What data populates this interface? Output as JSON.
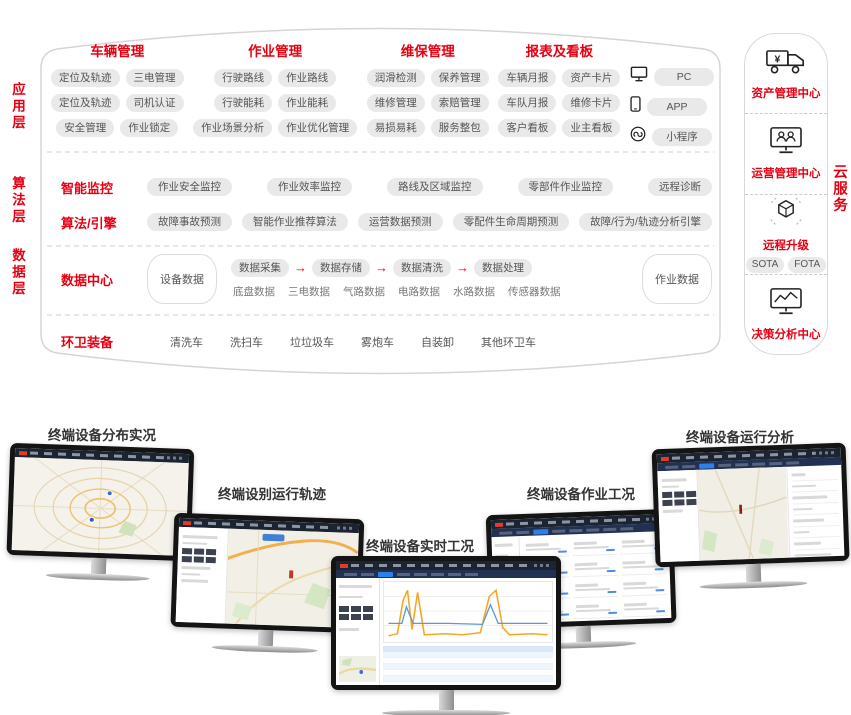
{
  "colors": {
    "accent_red": "#e60012",
    "pill_background": "#e9e9e9",
    "outline_gray": "#d5d5d5",
    "monitor_topbar": "#1c2431"
  },
  "layers": [
    "应用层",
    "算法层",
    "数据层"
  ],
  "app_groups": [
    {
      "title": "车辆管理",
      "rows": [
        [
          "定位及轨迹",
          "三电管理"
        ],
        [
          "定位及轨迹",
          "司机认证"
        ],
        [
          "安全管理",
          "作业锁定"
        ]
      ]
    },
    {
      "title": "作业管理",
      "rows": [
        [
          "行驶路线",
          "作业路线"
        ],
        [
          "行驶能耗",
          "作业能耗"
        ],
        [
          "作业场景分析",
          "作业优化管理"
        ]
      ]
    },
    {
      "title": "维保管理",
      "rows": [
        [
          "润滑检测",
          "保养管理"
        ],
        [
          "维修管理",
          "索赔管理"
        ],
        [
          "易损易耗",
          "服务整包"
        ]
      ]
    },
    {
      "title": "报表及看板",
      "rows": [
        [
          "车辆月报",
          "资产卡片"
        ],
        [
          "车队月报",
          "维修卡片"
        ],
        [
          "客户看板",
          "业主看板"
        ]
      ]
    }
  ],
  "clients": [
    {
      "icon": "pc-icon",
      "label": "PC"
    },
    {
      "icon": "phone-icon",
      "label": "APP"
    },
    {
      "icon": "miniprogram-icon",
      "label": "小程序"
    }
  ],
  "algo_rows": [
    {
      "title": "智能监控",
      "pills": [
        "作业安全监控",
        "作业效率监控",
        "路线及区域监控",
        "零部件作业监控",
        "远程诊断"
      ]
    },
    {
      "title": "算法/引擎",
      "pills": [
        "故障事故预测",
        "智能作业推荐算法",
        "运营数据预测",
        "零配件生命周期预测",
        "故障/行为/轨迹分析引擎"
      ]
    }
  ],
  "data_center": {
    "title": "数据中心",
    "left_db": "设备数据",
    "flow": [
      "数据采集",
      "数据存储",
      "数据清洗",
      "数据处理"
    ],
    "types": [
      "底盘数据",
      "三电数据",
      "气路数据",
      "电路数据",
      "水路数据",
      "传感器数据"
    ],
    "right_db": "作业数据"
  },
  "equipment": {
    "title": "环卫装备",
    "items": [
      "清洗车",
      "洗扫车",
      "垃垃圾车",
      "雾炮车",
      "自装卸",
      "其他环卫车"
    ]
  },
  "cloud_label": "云服务",
  "cloud_sections": [
    {
      "icon": "asset-truck-icon",
      "label": "资产管理中心",
      "pills": []
    },
    {
      "icon": "operations-monitor-icon",
      "label": "运营管理中心",
      "pills": []
    },
    {
      "icon": "ota-cube-icon",
      "label": "远程升级",
      "pills": [
        "SOTA",
        "FOTA"
      ]
    },
    {
      "icon": "decision-chart-icon",
      "label": "决策分析中心",
      "pills": []
    }
  ],
  "monitors": [
    {
      "label": "终端设备分布实况",
      "content": "city-map-overview"
    },
    {
      "label": "终端设别运行轨迹",
      "content": "vehicle-track-map"
    },
    {
      "label": "终端设备实时工况",
      "content": "realtime-telemetry-chart"
    },
    {
      "label": "终端设备作业工况",
      "content": "operation-status-cards"
    },
    {
      "label": "终端设备运行分析",
      "content": "operation-analysis"
    }
  ]
}
